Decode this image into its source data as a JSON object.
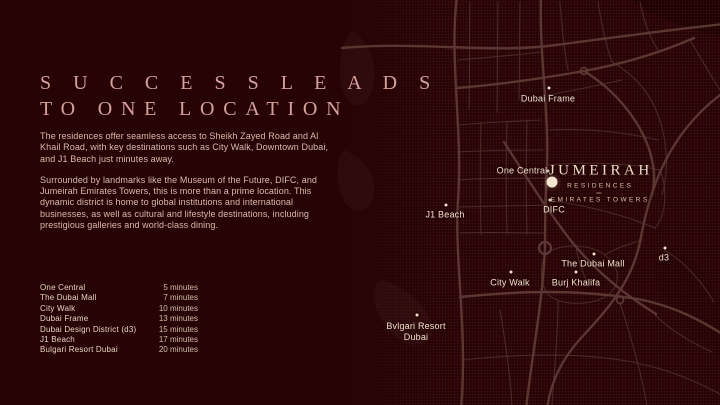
{
  "colors": {
    "background": "#270306",
    "road_major": "#5b3834",
    "road_minor": "#472a27",
    "headline": "#d4a19d",
    "body_text": "#d7bcad",
    "map_label": "#f1e1cd",
    "marker": "#f4e5cf"
  },
  "headline": {
    "line1": "S U C C E S S   L E A D S",
    "line2": "TO ONE LOCATION"
  },
  "paragraphs": {
    "p1": "The residences offer seamless access to Sheikh Zayed Road and Al Khail Road, with key destinations such as City Walk, Downtown Dubai, and J1 Beach just minutes away.",
    "p2": "Surrounded by landmarks like the Museum of the Future, DIFC, and Jumeirah Emirates Towers, this is more than a prime location. This dynamic district is home to global institutions and international businesses, as well as cultural and lifestyle destinations, including prestigious galleries and world-class dining."
  },
  "destinations": {
    "rows": [
      {
        "name": "One Central",
        "time": "5 minutes"
      },
      {
        "name": "The Dubai Mall",
        "time": "7 minutes"
      },
      {
        "name": "City Walk",
        "time": "10 minutes"
      },
      {
        "name": "Dubai Frame",
        "time": "13 minutes"
      },
      {
        "name": "Dubai Design District (d3)",
        "time": "15 minutes"
      },
      {
        "name": "J1 Beach",
        "time": "17 minutes"
      },
      {
        "name": "Bulgari Resort Dubai",
        "time": "20 minutes"
      }
    ]
  },
  "map": {
    "brand": {
      "title": "JUMEIRAH",
      "line2": "RESIDENCES",
      "line3": "EMIRATES TOWERS"
    },
    "labels": [
      {
        "text": "Dubai Frame",
        "x": 548,
        "y": 99,
        "dot": {
          "x": 549,
          "y": 88
        }
      },
      {
        "text": "One Central",
        "x": 522,
        "y": 171,
        "dot": {
          "x": 548,
          "y": 171
        }
      },
      {
        "text": "DIFC",
        "x": 554,
        "y": 210,
        "dot": {
          "x": 550,
          "y": 200
        }
      },
      {
        "text": "J1 Beach",
        "x": 445,
        "y": 215,
        "dot": {
          "x": 446,
          "y": 205
        }
      },
      {
        "text": "City Walk",
        "x": 510,
        "y": 283,
        "dot": {
          "x": 511,
          "y": 272
        }
      },
      {
        "text": "Burj Khalifa",
        "x": 576,
        "y": 283,
        "dot": {
          "x": 576,
          "y": 272
        }
      },
      {
        "text": "The Dubai Mall",
        "x": 593,
        "y": 264,
        "dot": {
          "x": 594,
          "y": 254
        }
      },
      {
        "text": "d3",
        "x": 664,
        "y": 258,
        "dot": {
          "x": 665,
          "y": 248
        }
      },
      {
        "text": "Bvlgari Resort\nDubai",
        "x": 416,
        "y": 332,
        "dot": {
          "x": 417,
          "y": 315
        }
      }
    ]
  }
}
